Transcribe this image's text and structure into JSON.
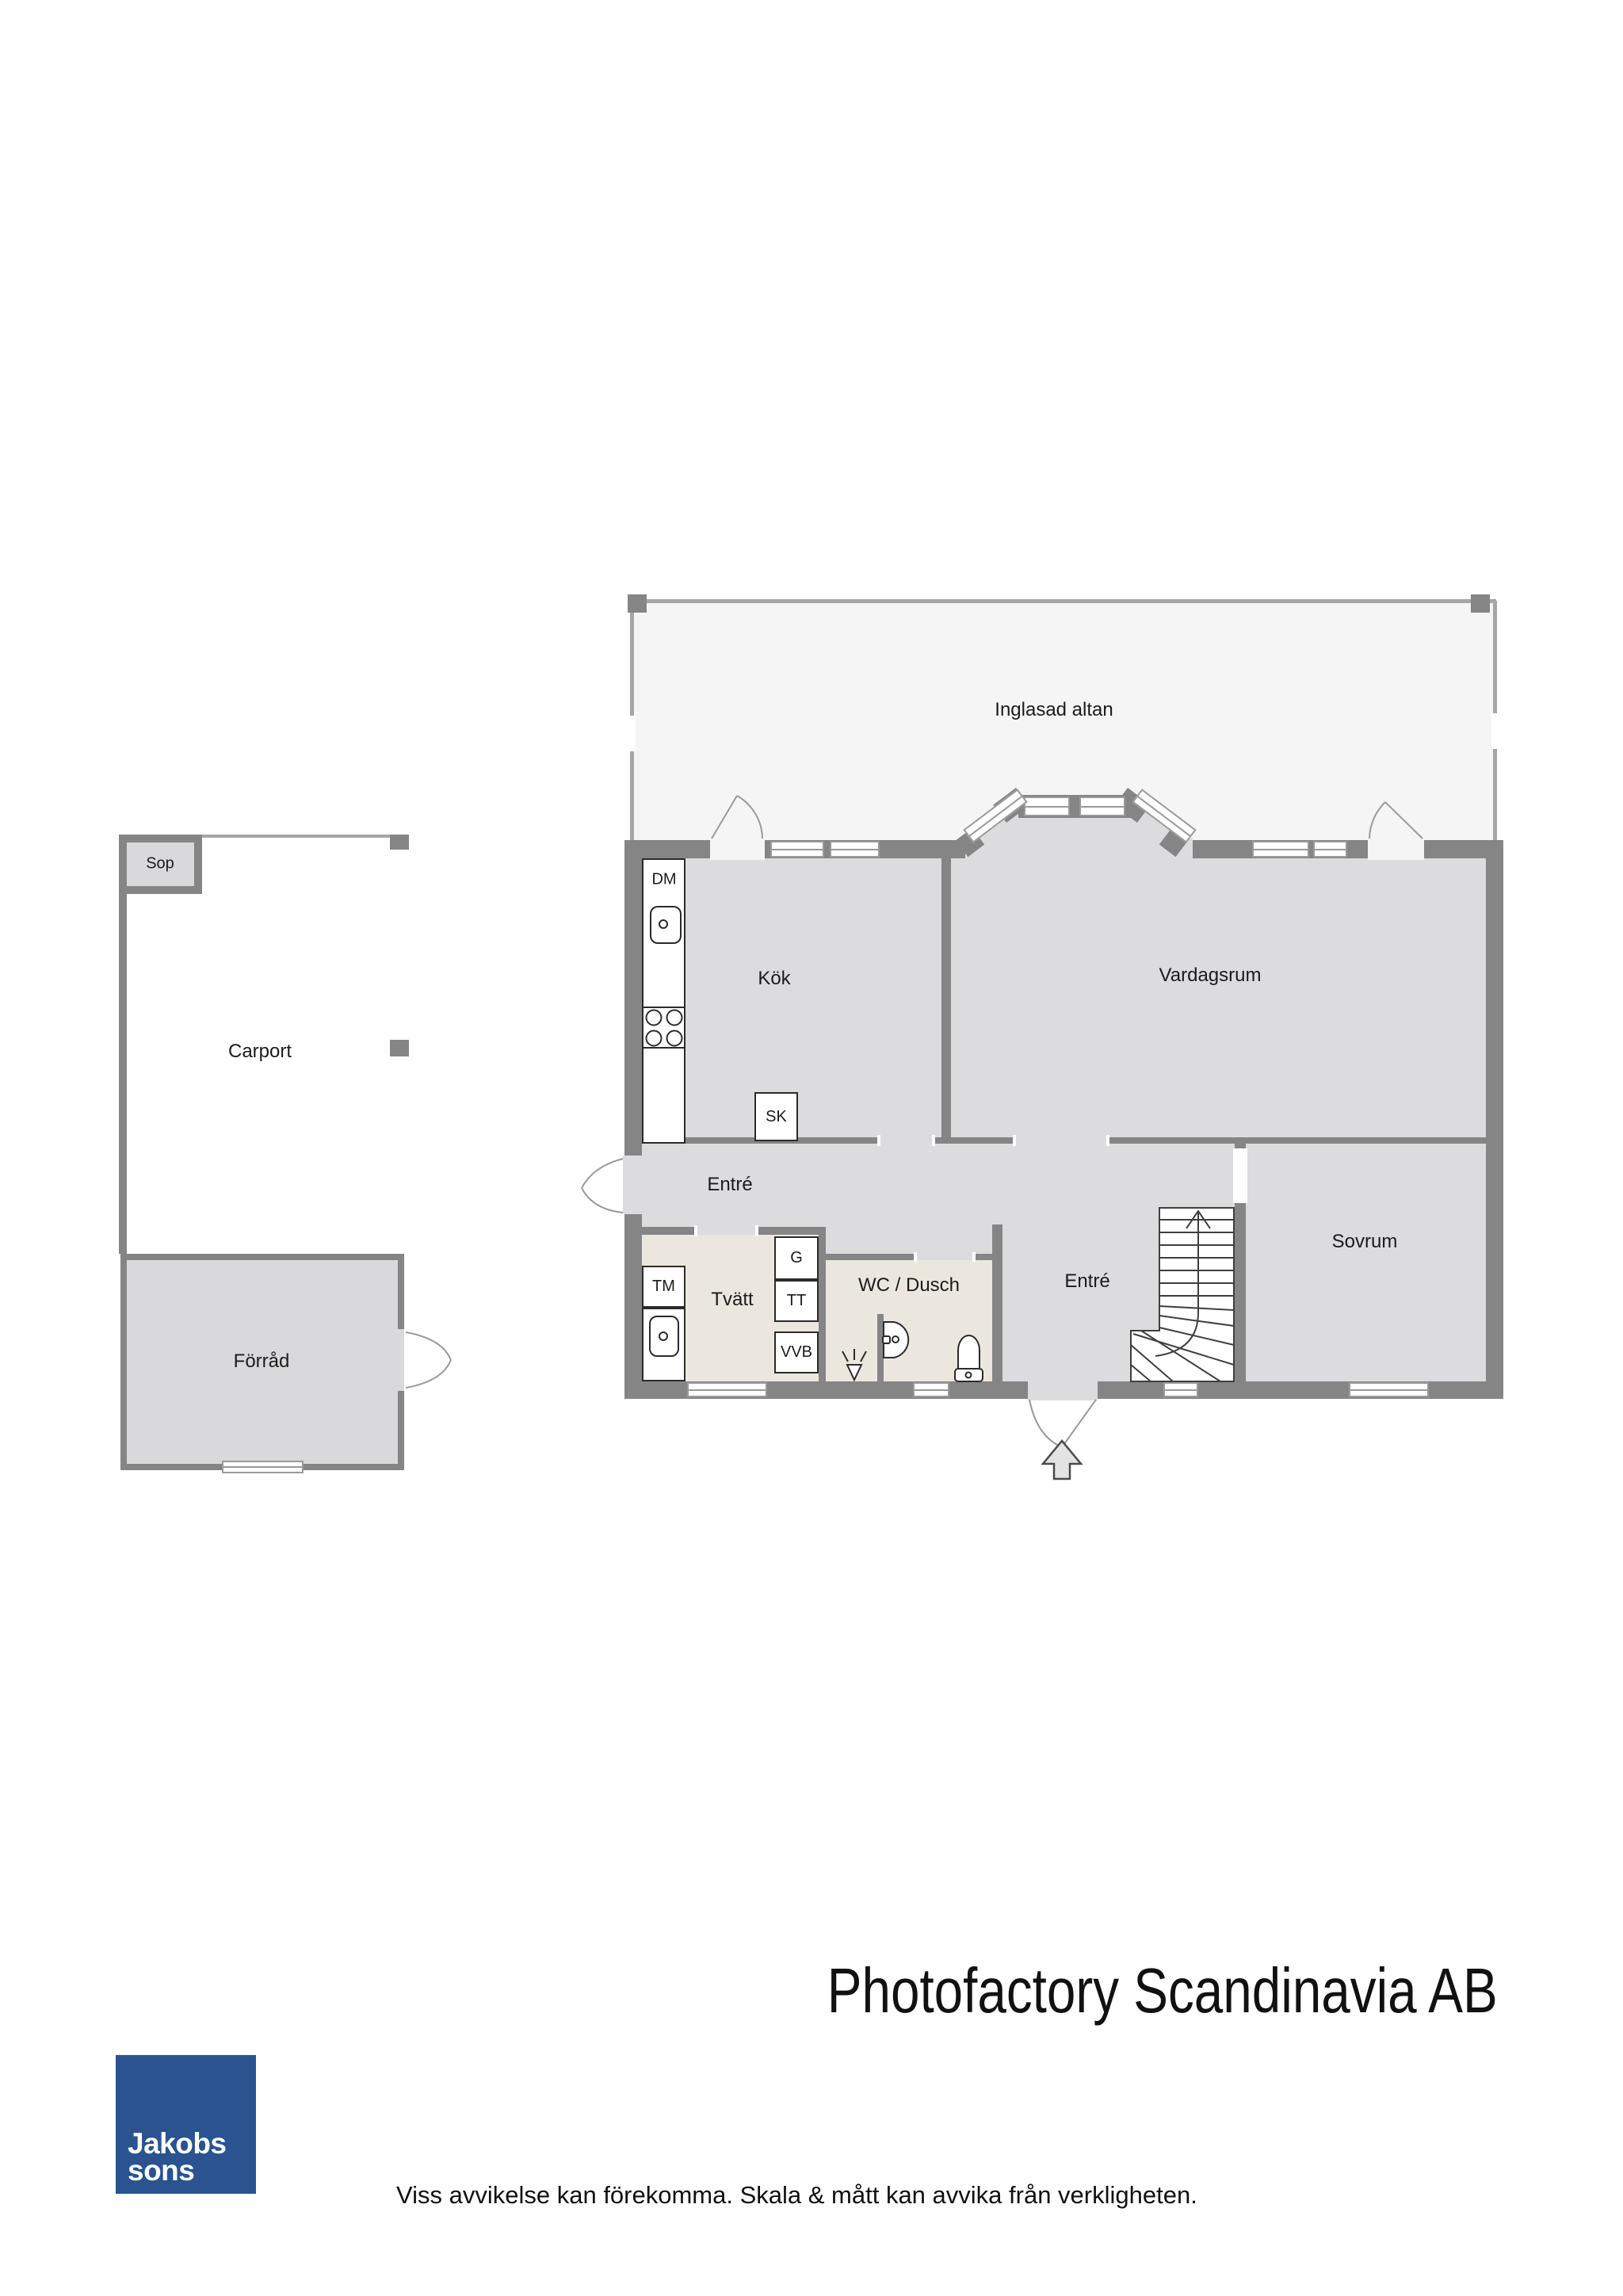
{
  "rooms": {
    "porch": "Inglasad altan",
    "kitchen": "Kök",
    "living": "Vardagsrum",
    "hall": "Entré",
    "inner_hall": "Entré",
    "bedroom": "Sovrum",
    "laundry": "Tvätt",
    "bath": "WC / Dusch",
    "trash": "Sop",
    "carport": "Carport",
    "storage": "Förråd"
  },
  "fixtures": {
    "dishwasher": "DM",
    "tall_cabinet": "SK",
    "washing_machine": "TM",
    "wardrobe": "G",
    "dryer": "TT",
    "water_heater": "VVB"
  },
  "branding": {
    "company": "Photofactory Scandinavia AB",
    "logo_line1": "Jakobs",
    "logo_line2": "sons",
    "disclaimer": "Viss avvikelse kan förekomma. Skala & mått kan avvika från verkligheten."
  },
  "colors": {
    "wall": "#858585",
    "room_fill": "#dcdcde",
    "wet_room_fill": "#ebe7de",
    "porch_fill": "#f5f5f6",
    "outbuilding_fill": "#d9d9db",
    "logo_blue": "#2a5390"
  }
}
